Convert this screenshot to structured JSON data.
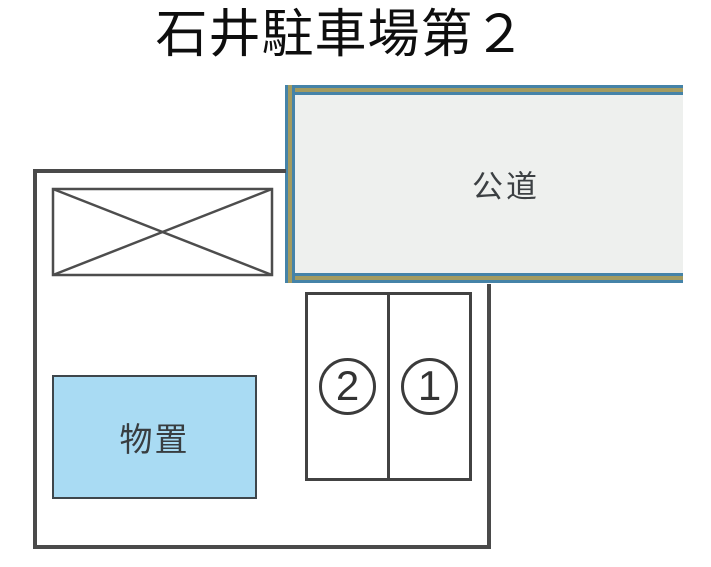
{
  "title": "石井駐車場第２",
  "road": {
    "label": "公道"
  },
  "storage": {
    "label": "物置"
  },
  "stalls": [
    {
      "number": "2"
    },
    {
      "number": "1"
    }
  ],
  "colors": {
    "road_fill": "#eef0ee",
    "road_border_blue": "#4583a8",
    "road_border_tan": "#a39b60",
    "storage_fill": "#a9dbf3",
    "boundary_line": "#4a4a4a",
    "ink": "#0e0e0e"
  }
}
